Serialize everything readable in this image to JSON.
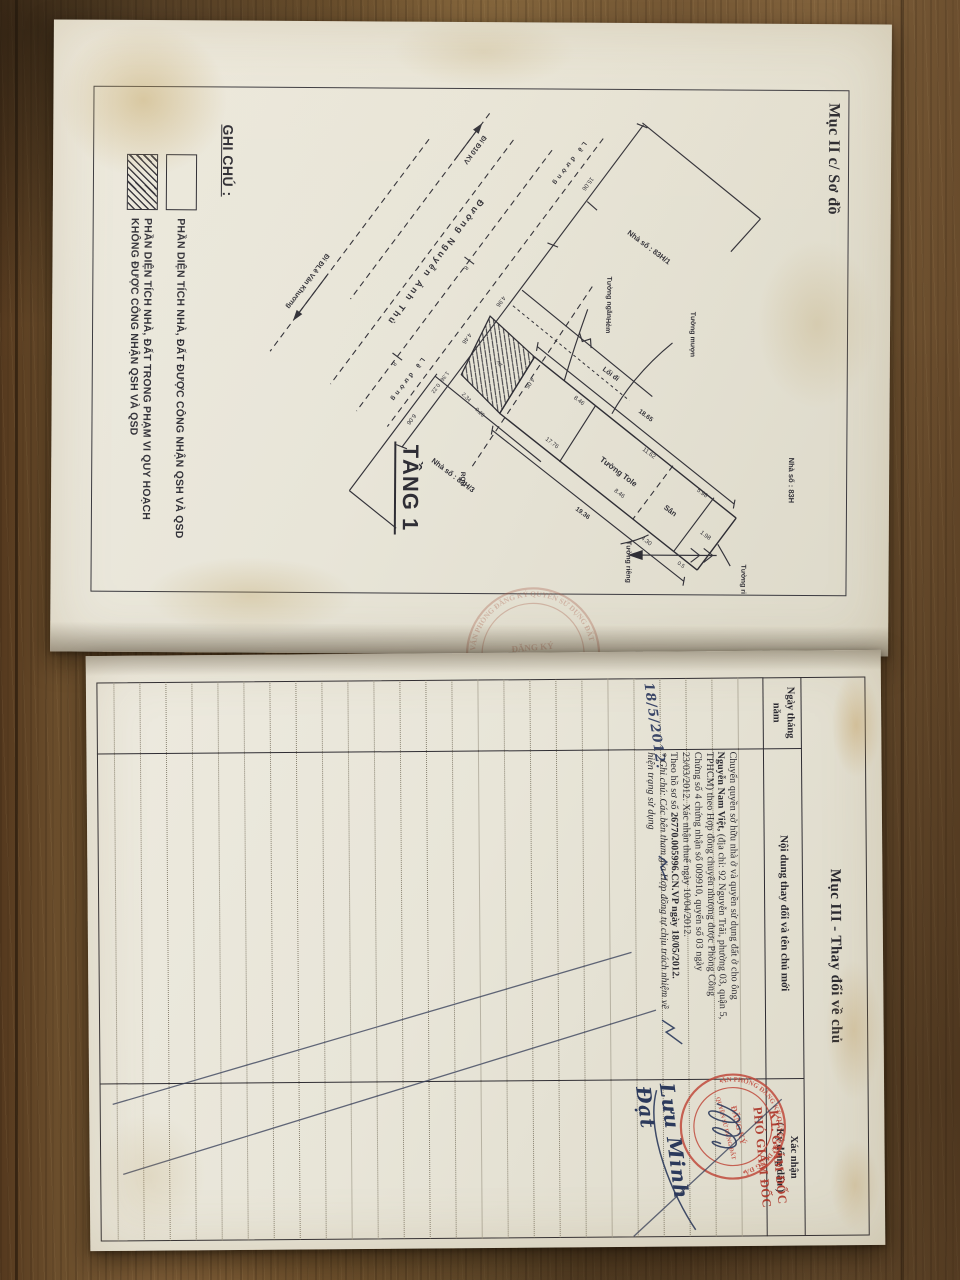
{
  "top_page": {
    "section_label": "Mục II c/ Sơ đồ",
    "floor_label": "TẦNG 1",
    "legend": {
      "title": "GHI CHÚ :",
      "item1": "PHẦN DIỆN TÍCH NHÀ, ĐẤT ĐƯỢC CÔNG NHẬN QSH VÀ QSD",
      "item2_line1": "PHẦN DIỆN TÍCH NHÀ, ĐẤT TRONG PHẠM VI QUY HOẠCH",
      "item2_line2": "KHÔNG ĐƯỢC CÔNG NHẬN QSH VÀ QSD"
    },
    "plan": {
      "street_name": "Đường Nguyễn Ảnh Thủ",
      "dir_left": "Đi Đ10 KV",
      "dir_right": "Đi ĐLê Văn Khương",
      "road_edge1": "Lề đường",
      "road_edge2": "Lề đường",
      "house_main": "Nhà số : 83H",
      "house_n1": "Nhà số : 83H/1",
      "house_n3": "Nhà số : 83H/3",
      "wall_borrowed": "Tường mượn",
      "wall_private_1": "Tường riêng",
      "wall_private_2": "Tường riêng",
      "wall_partition": "Tường ngăn",
      "wall_tole": "Tường Tole",
      "yard": "Sân",
      "alley": "Hẻm",
      "walkway": "Lối đi",
      "boundary": "RQH",
      "plot_mark": "xd",
      "dims": {
        "front_left": "15.06",
        "alley_front": "4.96",
        "plot_front": "4.46",
        "jog1": "1.36",
        "jog2": "0.22",
        "front_right": "6.06",
        "plot_rear": "4.05",
        "edge1": "2.34",
        "edge2": "0.25",
        "left_outer": "18.65",
        "left_front": "8.46",
        "left_mid": "11.62",
        "left_end": "5.98",
        "right_outer": "19.36",
        "right_front": "17.76",
        "right_mid": "8.46",
        "yard_w": "4.30",
        "end_room": "1.98",
        "end_small": "0.5",
        "road_w1": "8",
        "road_w2": "8"
      }
    },
    "fold_stamp": {
      "ring": "VĂN PHÒNG ĐĂNG KÝ QUYỀN SỬ DỤNG ĐẤT",
      "center1": "ĐĂNG KÝ",
      "center2": "SỐ 4"
    }
  },
  "bottom_page": {
    "section_title": "Mục III - Thay đổi về chủ",
    "columns": {
      "date_l1": "Ngày tháng",
      "date_l2": "năm",
      "content": "Nội dung thay đổi và tên chủ mới",
      "confirm_l1": "Xác nhận",
      "confirm_l2": "( Ký đóng dấu )"
    },
    "entry": {
      "date": "18/5/2012.",
      "line1": "Chuyển quyền sở hữu nhà ở và quyền sử dụng đất ở cho ông",
      "line2_bold": "Nguyễn Nam Việt,",
      "line2_rest": " (địa chỉ: 92 Nguyễn Trãi, phường 03, quận 5,",
      "line3": "TPHCM) theo Hợp đồng chuyển nhượng được Phòng Công",
      "line4": "Chứng số 4 chứng nhận số 009910, quyển số 03 ngày",
      "line5": "23/03/2012. Xác nhận thuế ngày 10/04/2012.",
      "line6_pre": "Theo hồ sơ số ",
      "line6_bold": "26770.005996.CN.VP ngày 18/05/2012.",
      "line7": "* Ghi chú: Các bên tham gia Hợp đồng tự chịu trách nhiệm về",
      "line8": "hiện trạng sử dụng"
    },
    "approval": {
      "kt": "KT. GIÁM ĐỐC",
      "pho": "PHÓ GIÁM ĐỐC",
      "signer": "Lưu Minh Đạt"
    },
    "stamp": {
      "ring": "VĂN PHÒNG ĐĂNG KÝ QUYỀN SỬ DỤNG ĐẤT",
      "center1": "ĐĂNG KÝ",
      "center2": "QUYỀN SỬ DỤNG ĐẤT"
    }
  }
}
